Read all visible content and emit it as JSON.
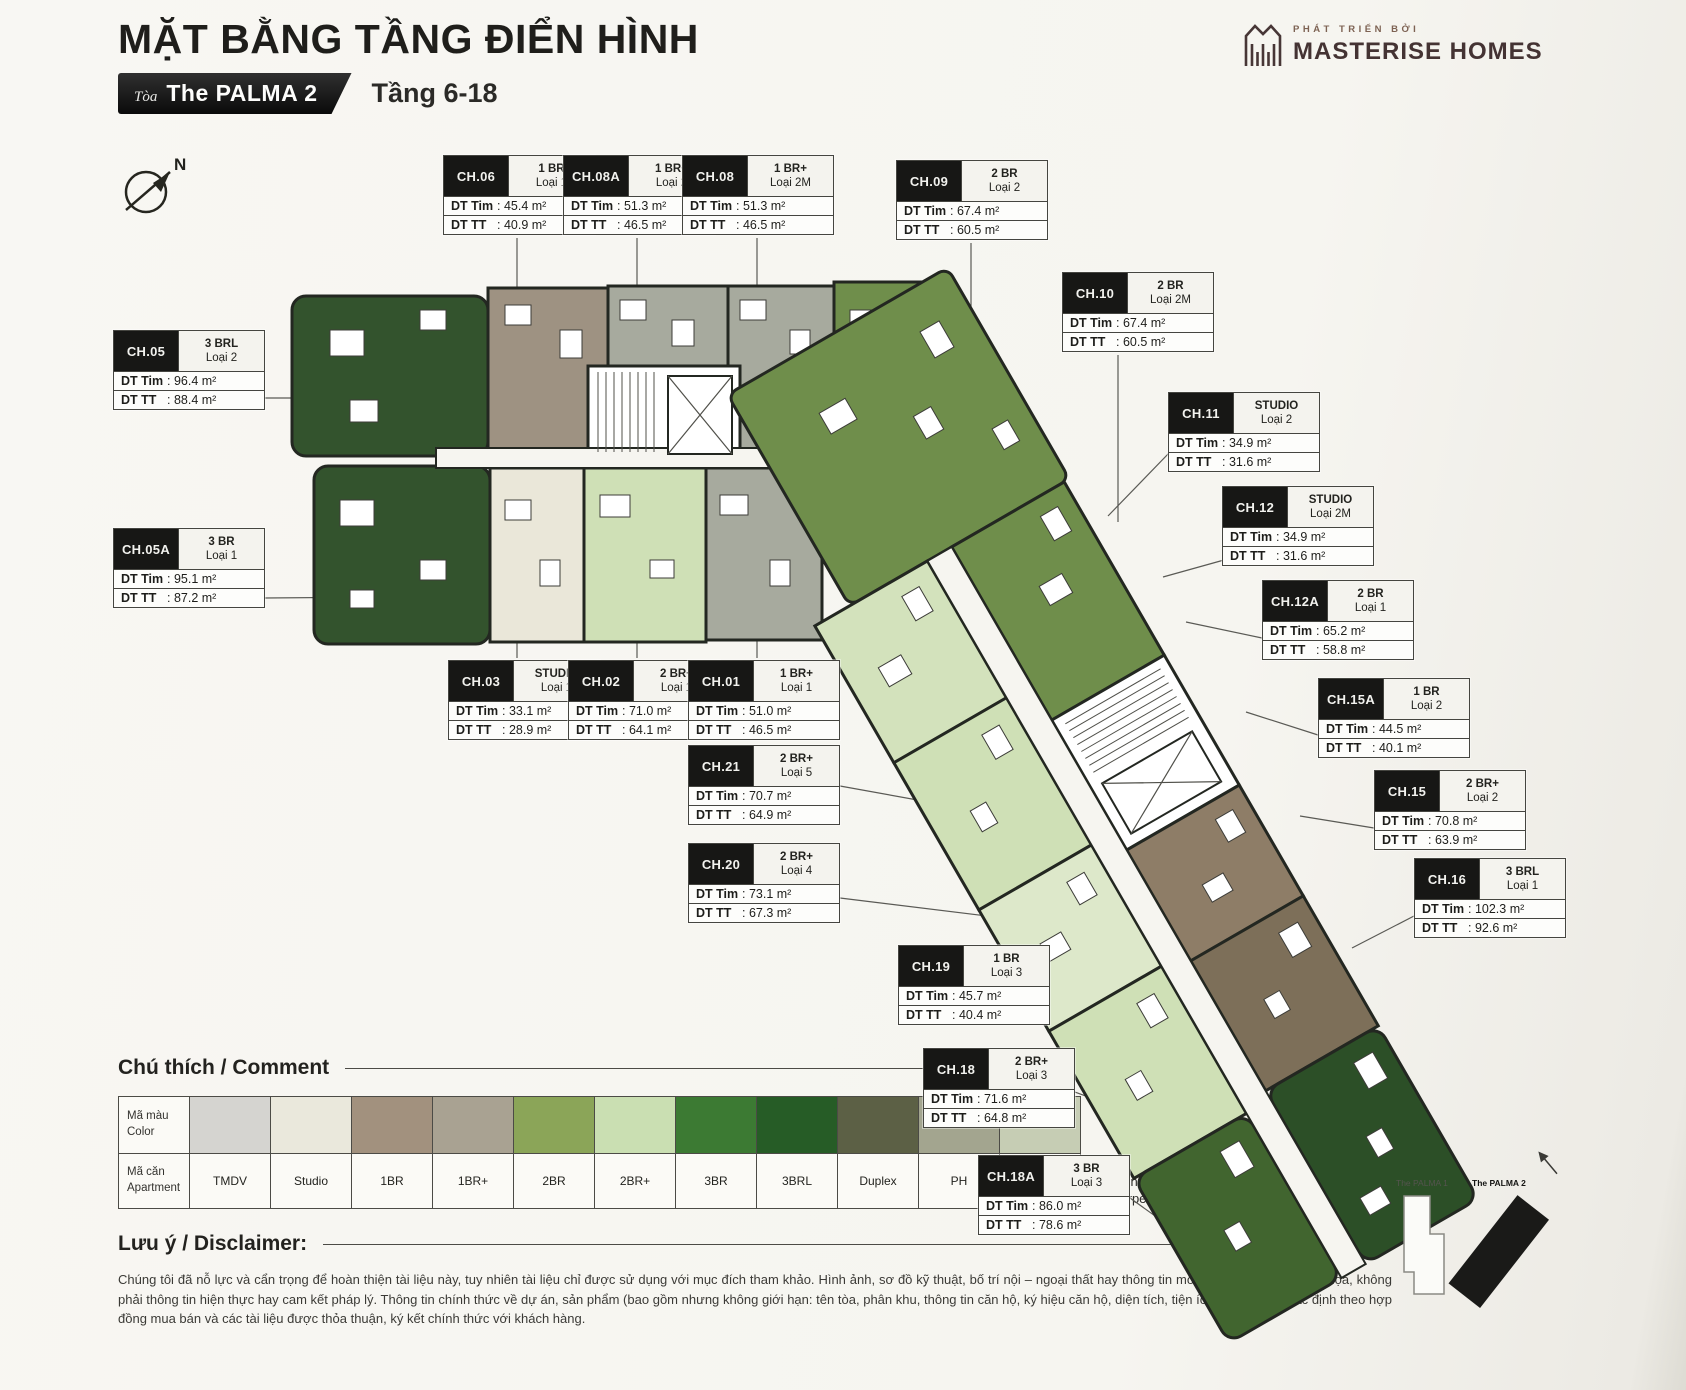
{
  "header": {
    "title": "MẶT BẰNG TẦNG ĐIỂN HÌNH",
    "building_label_prefix": "Tòa",
    "building_name": "The PALMA 2",
    "floors": "Tầng 6-18"
  },
  "logo": {
    "tagline": "PHÁT TRIỂN BỞI",
    "brand": "MASTERISE HOMES"
  },
  "compass": {
    "north": "N"
  },
  "labels": {
    "tim": "DT Tim",
    "tt": "DT TT"
  },
  "units": [
    {
      "code": "CH.05",
      "type": "3 BRL",
      "variant": "Loại 2",
      "tim": ": 96.4 m²",
      "tt": ": 88.4 m²"
    },
    {
      "code": "CH.05A",
      "type": "3 BR",
      "variant": "Loại 1",
      "tim": ": 95.1 m²",
      "tt": ": 87.2 m²"
    },
    {
      "code": "CH.06",
      "type": "1 BR",
      "variant": "Loại 1",
      "tim": ": 45.4 m²",
      "tt": ": 40.9 m²"
    },
    {
      "code": "CH.08A",
      "type": "1 BR+",
      "variant": "Loại 2",
      "tim": ": 51.3 m²",
      "tt": ": 46.5 m²"
    },
    {
      "code": "CH.08",
      "type": "1 BR+",
      "variant": "Loại 2M",
      "tim": ": 51.3 m²",
      "tt": ": 46.5 m²"
    },
    {
      "code": "CH.09",
      "type": "2 BR",
      "variant": "Loại 2",
      "tim": ": 67.4 m²",
      "tt": ": 60.5 m²"
    },
    {
      "code": "CH.10",
      "type": "2 BR",
      "variant": "Loại 2M",
      "tim": ": 67.4 m²",
      "tt": ": 60.5 m²"
    },
    {
      "code": "CH.11",
      "type": "STUDIO",
      "variant": "Loại 2",
      "tim": ": 34.9 m²",
      "tt": ": 31.6 m²"
    },
    {
      "code": "CH.12",
      "type": "STUDIO",
      "variant": "Loại 2M",
      "tim": ": 34.9 m²",
      "tt": ": 31.6 m²"
    },
    {
      "code": "CH.12A",
      "type": "2 BR",
      "variant": "Loại 1",
      "tim": ": 65.2 m²",
      "tt": ": 58.8 m²"
    },
    {
      "code": "CH.15A",
      "type": "1 BR",
      "variant": "Loại 2",
      "tim": ": 44.5 m²",
      "tt": ": 40.1 m²"
    },
    {
      "code": "CH.15",
      "type": "2 BR+",
      "variant": "Loại 2",
      "tim": ": 70.8 m²",
      "tt": ": 63.9 m²"
    },
    {
      "code": "CH.16",
      "type": "3 BRL",
      "variant": "Loại 1",
      "tim": ": 102.3 m²",
      "tt": ": 92.6 m²"
    },
    {
      "code": "CH.03",
      "type": "STUDIO",
      "variant": "Loại 1",
      "tim": ": 33.1 m²",
      "tt": ": 28.9 m²"
    },
    {
      "code": "CH.02",
      "type": "2 BR+",
      "variant": "Loại 1",
      "tim": ": 71.0 m²",
      "tt": ": 64.1 m²"
    },
    {
      "code": "CH.01",
      "type": "1 BR+",
      "variant": "Loại 1",
      "tim": ": 51.0 m²",
      "tt": ": 46.5 m²"
    },
    {
      "code": "CH.21",
      "type": "2 BR+",
      "variant": "Loại 5",
      "tim": ": 70.7 m²",
      "tt": ": 64.9 m²"
    },
    {
      "code": "CH.20",
      "type": "2 BR+",
      "variant": "Loại 4",
      "tim": ": 73.1 m²",
      "tt": ": 67.3 m²"
    },
    {
      "code": "CH.19",
      "type": "1 BR",
      "variant": "Loại 3",
      "tim": ": 45.7 m²",
      "tt": ": 40.4 m²"
    },
    {
      "code": "CH.18",
      "type": "2 BR+",
      "variant": "Loại 3",
      "tim": ": 71.6 m²",
      "tt": ": 64.8 m²"
    },
    {
      "code": "CH.18A",
      "type": "3 BR",
      "variant": "Loại 3",
      "tim": ": 86.0 m²",
      "tt": ": 78.6 m²"
    }
  ],
  "legend": {
    "heading": "Chú thích / Comment",
    "color_label_vi": "Mã màu",
    "color_label_en": "Color",
    "apt_label_vi": "Mã căn",
    "apt_label_en": "Apartment",
    "items": [
      {
        "label": "TMDV",
        "color": "#d5d4d0"
      },
      {
        "label": "Studio",
        "color": "#eae8dc"
      },
      {
        "label": "1BR",
        "color": "#a2917e"
      },
      {
        "label": "1BR+",
        "color": "#a9a292"
      },
      {
        "label": "2BR",
        "color": "#8ba558"
      },
      {
        "label": "2BR+",
        "color": "#cadfb2"
      },
      {
        "label": "3BR",
        "color": "#3c7a33"
      },
      {
        "label": "3BRL",
        "color": "#265c26"
      },
      {
        "label": "Duplex",
        "color": "#5c6045"
      },
      {
        "label": "PH",
        "color": "#a3a58f"
      },
      {
        "label": "PH Duplex",
        "color": "#c6cdb4"
      }
    ],
    "notes": [
      {
        "vi": "Diện Tích Tim Tường - DT Tim",
        "en": "Built-up Area"
      },
      {
        "vi": "Diện Tích Thông Thuỷ - DT TT",
        "en": "Carpet Area"
      }
    ]
  },
  "disclaimer": {
    "heading": "Lưu ý / Disclaimer:",
    "text": "Chúng tôi đã nỗ lực và cẩn trọng để hoàn thiện tài liệu này, tuy nhiên tài liệu chỉ được sử dụng với mục đích tham khảo. Hình ảnh, sơ đồ kỹ thuật, bố trí nội – ngoại thất hay thông tin mô tả chỉ mang tính minh họa, không phải thông tin hiện thực hay cam kết pháp lý. Thông tin chính thức về dự án, sản phẩm (bao gồm nhưng không giới hạn: tên tòa, phân khu, thông tin căn hộ, ký hiệu căn hộ, diện tích, tiện ích,...) sẽ được xác định theo hợp đồng mua bán và các tài liệu được thỏa thuận, ký kết chính thức với khách hàng."
  },
  "keyplan": {
    "buildings": [
      "The PALMA 1",
      "The PALMA 2"
    ]
  }
}
